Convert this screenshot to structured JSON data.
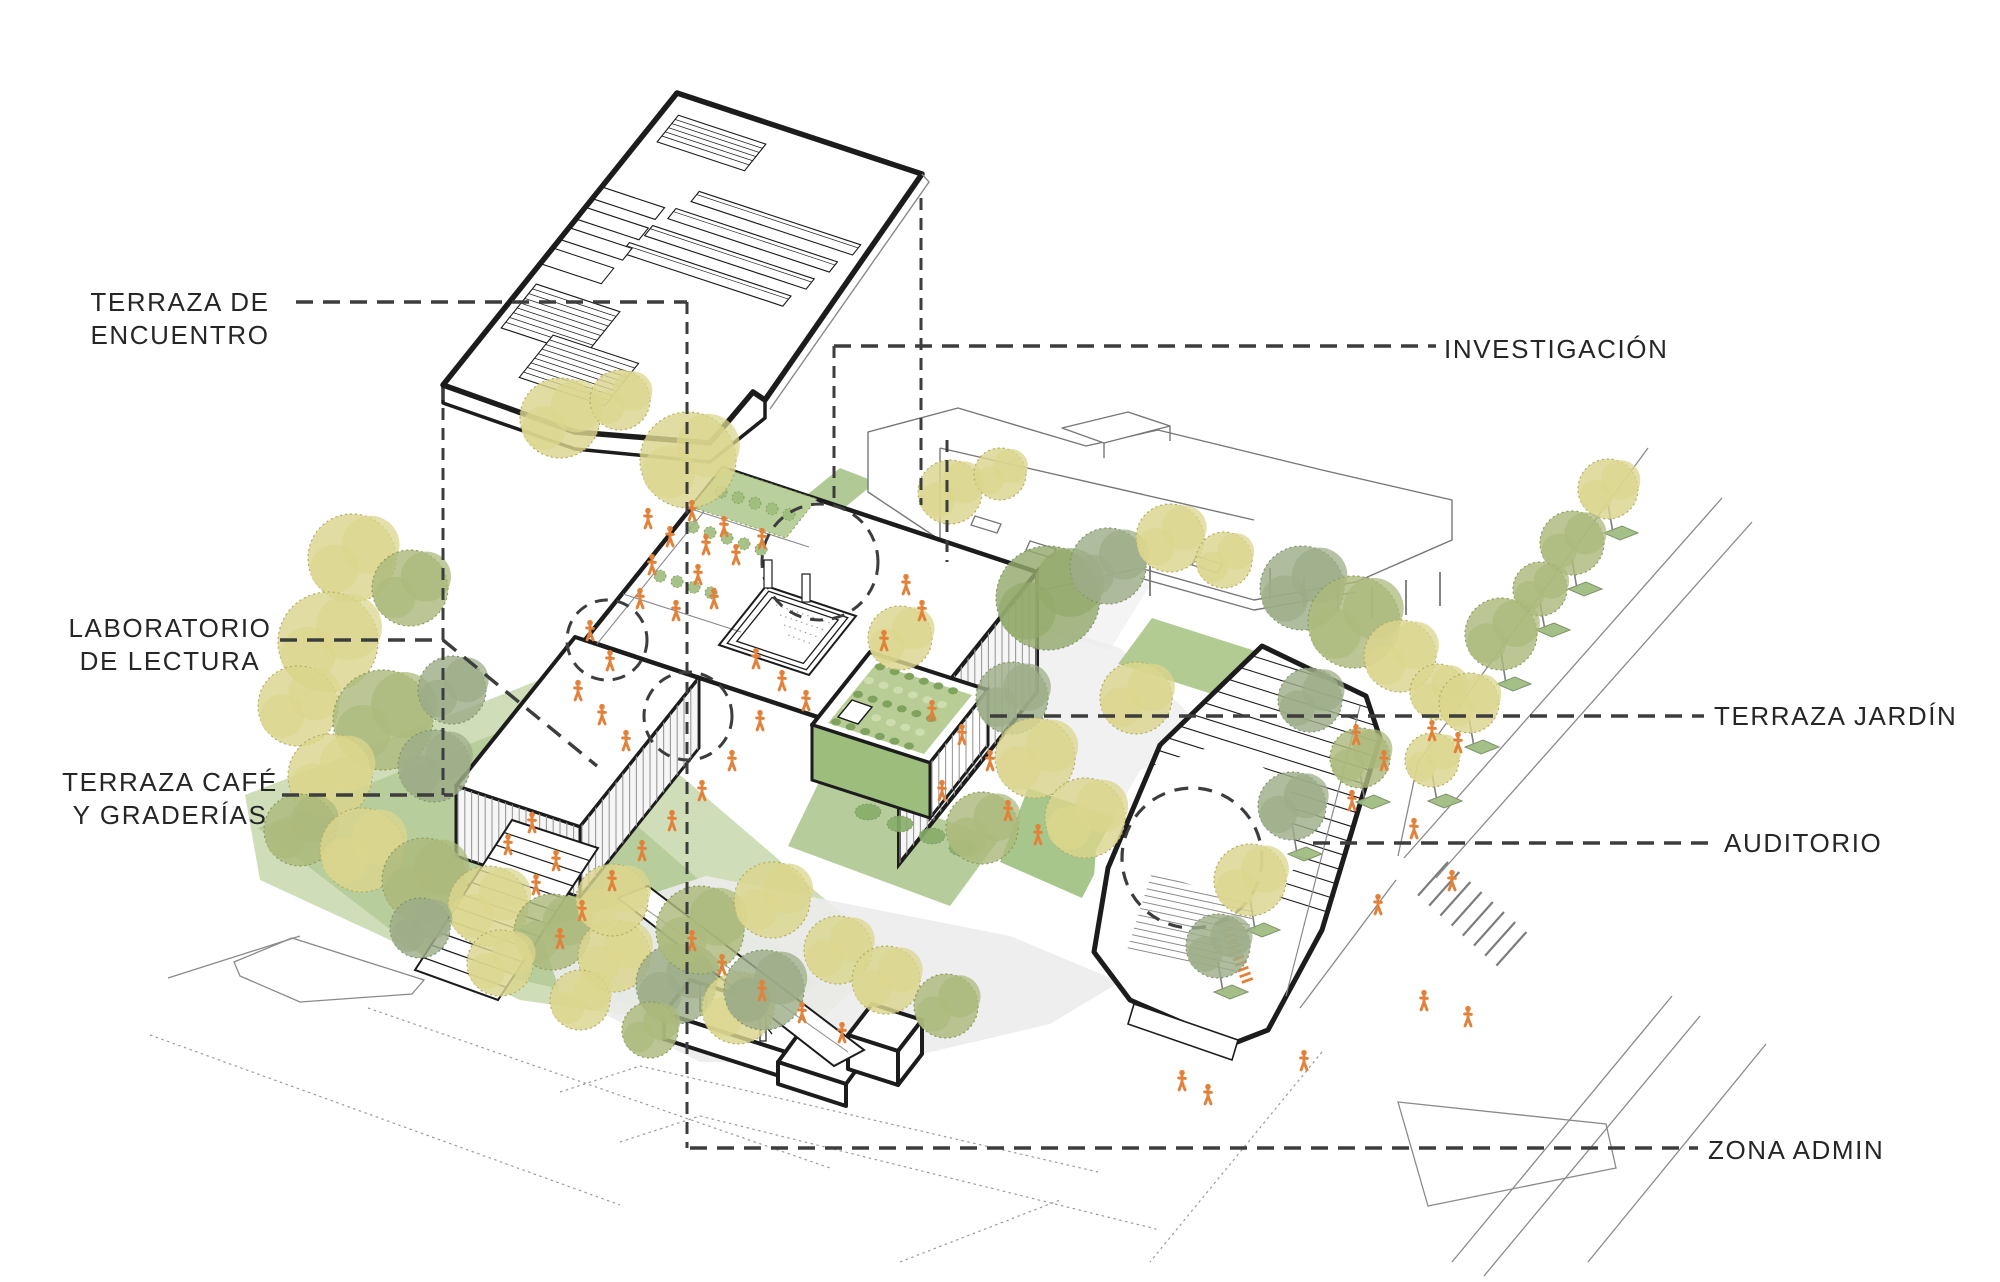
{
  "diagram": {
    "type": "exploded axonometric architectural diagram",
    "labels": [
      {
        "id": "terraza-de-encuentro",
        "text": "TERRAZA DE ENCUENTRO",
        "lines": [
          "TERRAZA DE",
          "ENCUENTRO"
        ],
        "side": "left"
      },
      {
        "id": "investigacion",
        "text": "INVESTIGACIÓN",
        "side": "right"
      },
      {
        "id": "laboratorio-de-lectura",
        "text": "LABORATORIO DE LECTURA",
        "lines": [
          "LABORATORIO",
          "DE LECTURA"
        ],
        "side": "left"
      },
      {
        "id": "terraza-jardin",
        "text": "TERRAZA JARDÍN",
        "side": "right"
      },
      {
        "id": "terraza-cafe-y-graderias",
        "text": "TERRAZA CAFÉ Y GRADERÍAS",
        "lines": [
          "TERRAZA CAFÉ",
          "Y GRADERÍAS"
        ],
        "side": "left"
      },
      {
        "id": "auditorio",
        "text": "AUDITORIO",
        "side": "right"
      },
      {
        "id": "zona-admin",
        "text": "ZONA ADMIN",
        "side": "right"
      }
    ],
    "palette": {
      "ink": "#1c1c1c",
      "dash": "#3d3d3d",
      "thin_line": "#8a8a8a",
      "tree_yellow": "#dbd58d",
      "tree_yellow_edge": "#b3ab63",
      "tree_olive": "#acba7c",
      "tree_olive_edge": "#8a9a59",
      "tree_olive_dark": "#93a96b",
      "tree_gray_green": "#9dad88",
      "tree_gray_edge": "#7f926d",
      "ground_green": "#c3d6a6",
      "ground_green_dark": "#9fbd80",
      "hedge_green": "#86ac68",
      "terrace_green": "#9dbd7c",
      "plaza_gray": "#ececec",
      "louver_gray": "#9a9a9a",
      "people_orange": "#e2813a",
      "paper_white": "#ffffff"
    }
  }
}
